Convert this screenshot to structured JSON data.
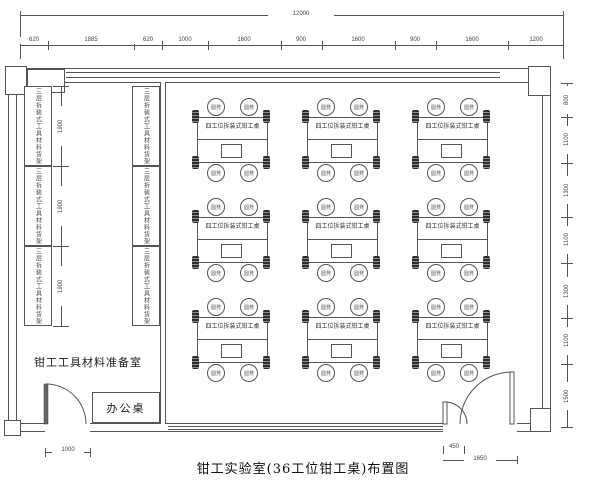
{
  "title": "钳工实验室(36工位钳工桌)布置图",
  "dims": {
    "overall": "12000",
    "top": [
      "620",
      "1885",
      "620",
      "1000",
      "1600",
      "900",
      "1600",
      "900",
      "1600",
      "1200"
    ],
    "right": [
      "800",
      "1100",
      "1300",
      "1100",
      "1300",
      "1100",
      "1500"
    ],
    "shelf": [
      "1900",
      "1900",
      "1900"
    ],
    "door_left": "1000",
    "door_small_leaf": "450",
    "door_right": "1650"
  },
  "rooms": {
    "prep_room": "钳工工具材料准备室",
    "desk": "办公桌"
  },
  "furniture": {
    "table_label": "四工位拆装式钳工桌",
    "stool_label": "圆凳",
    "shelf_label": "三层拆装式工具材料货架"
  },
  "colors": {
    "line": "#555555",
    "text": "#333333",
    "background": "#ffffff"
  }
}
